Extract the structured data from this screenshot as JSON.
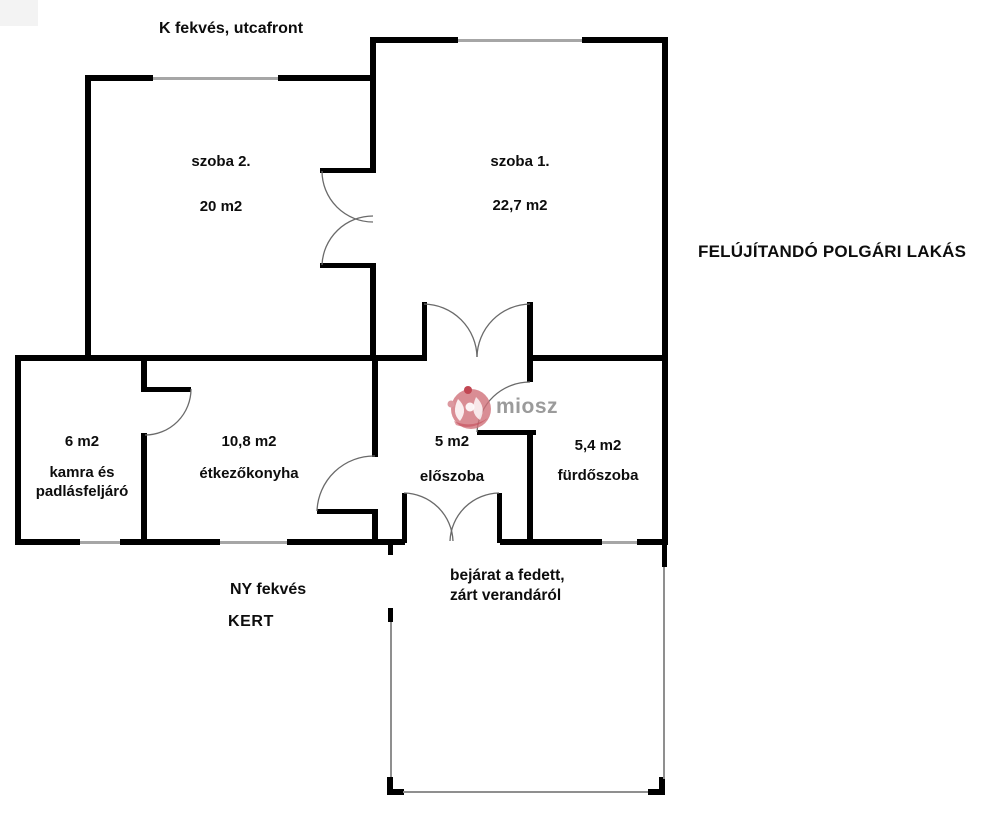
{
  "titles": {
    "top": "K fekvés, utcafront",
    "right": "FELÚJÍTANDÓ POLGÁRI LAKÁS",
    "orientation_bottom": "NY fekvés",
    "garden": "KERT",
    "entrance_note_line1": "bejárat a fedett,",
    "entrance_note_line2": "zárt verandáról"
  },
  "rooms": [
    {
      "id": "szoba2",
      "name": "szoba 2.",
      "area": "20 m2"
    },
    {
      "id": "szoba1",
      "name": "szoba 1.",
      "area": "22,7 m2"
    },
    {
      "id": "kamra",
      "area": "6 m2",
      "name": "kamra és",
      "name2": "padlásfeljáró"
    },
    {
      "id": "etkezokonyha",
      "area": "10,8 m2",
      "name": "étkezőkonyha"
    },
    {
      "id": "eloszoba",
      "area": "5 m2",
      "name": "előszoba"
    },
    {
      "id": "furdoszoba",
      "area": "5,4 m2",
      "name": "fürdőszoba"
    }
  ],
  "watermark": {
    "text": "miosz",
    "text_color": "#9b9b9b",
    "icon_color": "#cf7079"
  },
  "colors": {
    "wall": "#000000",
    "window_line": "#a6a6a6",
    "door_arc": "#6a6a6a",
    "veranda_line": "#8f8f8f",
    "background": "#ffffff"
  }
}
